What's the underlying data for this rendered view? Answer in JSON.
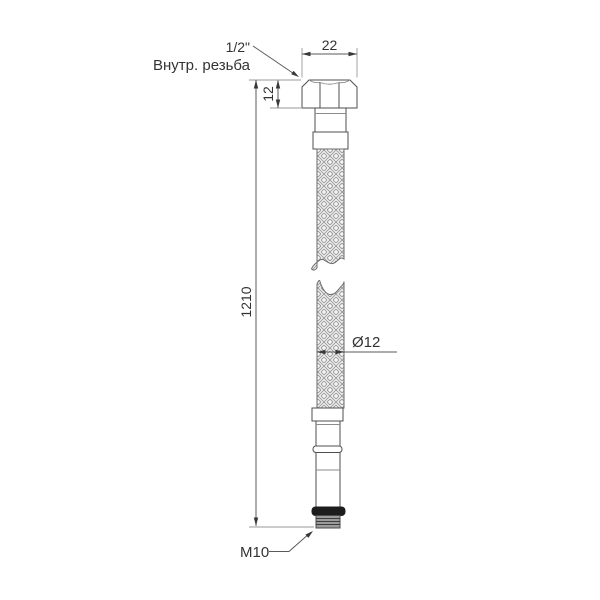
{
  "title": "Flexible hose dimensional drawing",
  "labels": {
    "top_thread_size": "1/2\"",
    "top_thread_type": "Внутр. резьба",
    "nut_width": "22",
    "nut_height": "12",
    "total_length": "1210",
    "hose_diameter": "Ø12",
    "bottom_thread": "M10"
  },
  "colors": {
    "line": "#4f4f4f",
    "dim": "#5a5a5a",
    "ext": "#9a9a9a",
    "arrow": "#383838",
    "text": "#333333",
    "braid-bg": "#f4f4f4",
    "braid-line": "#9a9a9a",
    "metal": "#ffffff",
    "gasket": "#1d1d1d",
    "stud": "#9b9b9b",
    "thread": "#3e3e3e",
    "bg": "#ffffff"
  }
}
